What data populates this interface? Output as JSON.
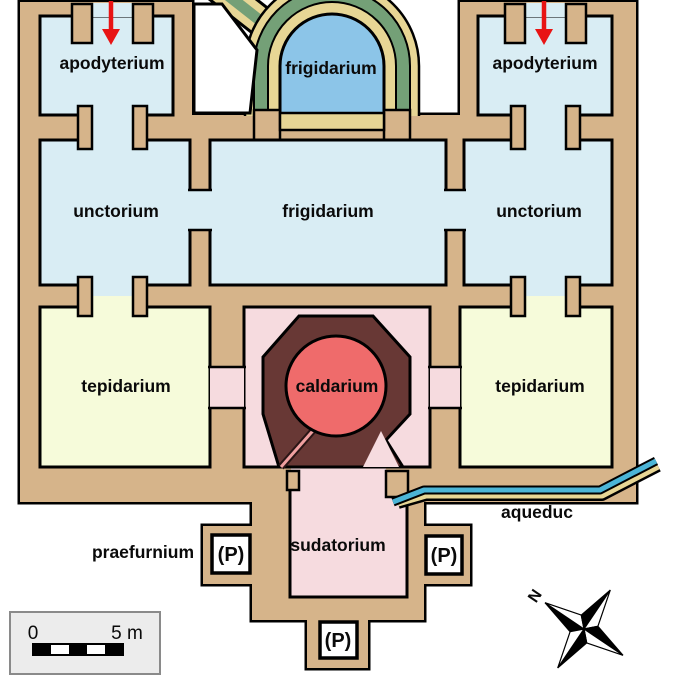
{
  "diagram": {
    "type": "roman-bath-floor-plan",
    "labels": {
      "apodyterium_left": "apodyterium",
      "apodyterium_right": "apodyterium",
      "frigidarium_pool": "frigidarium",
      "frigidarium_hall": "frigidarium",
      "unctorium_left": "unctorium",
      "unctorium_right": "unctorium",
      "tepidarium_left": "tepidarium",
      "tepidarium_right": "tepidarium",
      "caldarium": "caldarium",
      "sudatorium": "sudatorium",
      "praefurnium": "praefurnium",
      "aqueduct": "aqueduc",
      "p_marker_left": "(P)",
      "p_marker_right": "(P)",
      "p_marker_bottom": "(P)"
    },
    "scale_bar": {
      "start_label": "0",
      "end_label": "5 m"
    },
    "compass": {
      "north_label": "N"
    },
    "colors": {
      "wall": "#d6b48a",
      "outline": "#000000",
      "cold_room": "#d9edf4",
      "cold_pool": "#8cc5e8",
      "vault_green": "#74a077",
      "vault_khaki": "#e7d695",
      "warm_room": "#f6fbda",
      "hot_room": "#f6dbdf",
      "hypocaust_mass": "#683835",
      "hot_pool": "#ef6b6b",
      "aqueduct_water": "#4cb5d6",
      "entrance_arrow": "#e81414",
      "scale_box_bg": "#ececec"
    }
  }
}
